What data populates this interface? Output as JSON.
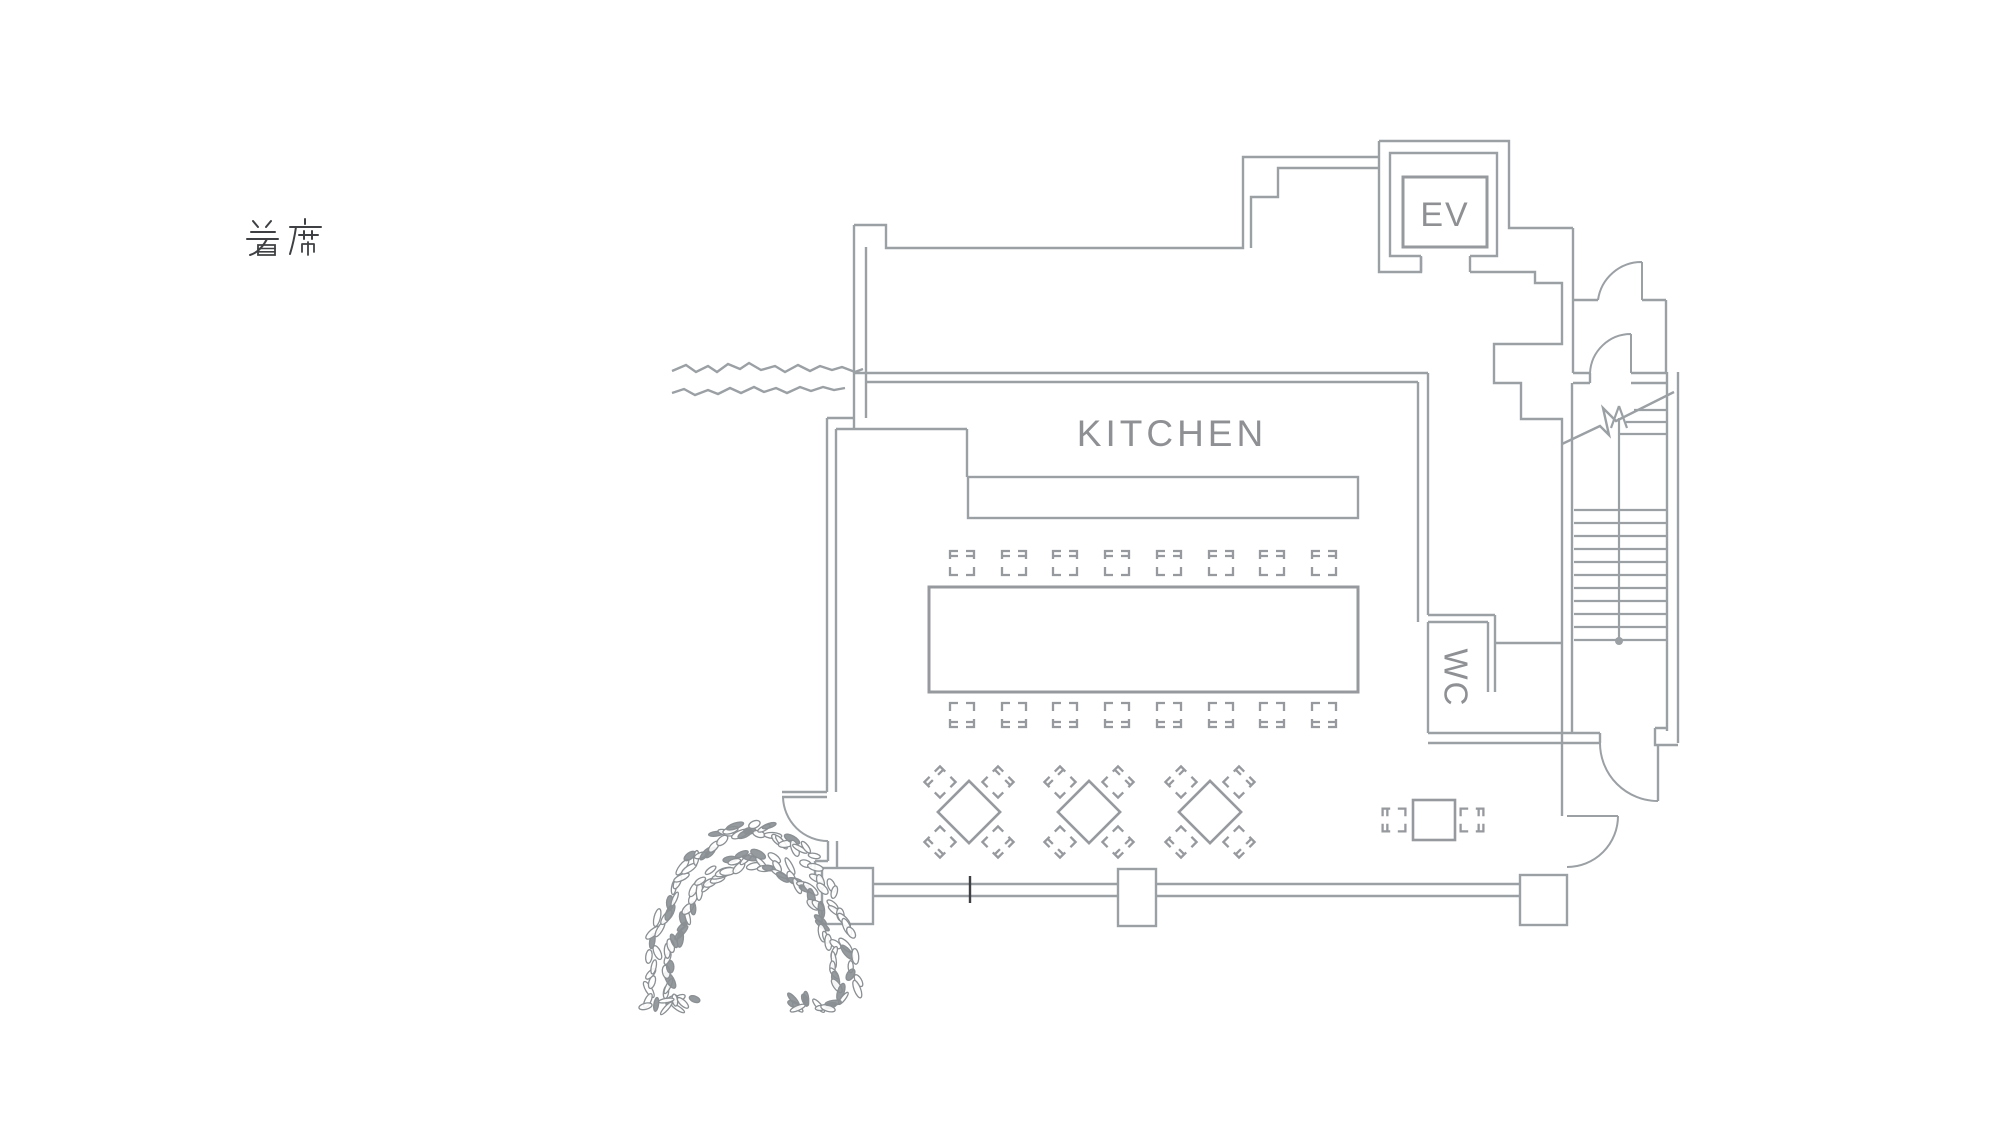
{
  "plan": {
    "seating_label": "着席",
    "labels": {
      "kitchen": "KITCHEN",
      "elevator": "EV",
      "toilet": "WC"
    },
    "colors": {
      "wall": "#9ba0a5",
      "furniture": "#96999d",
      "label_text": "#8e9094",
      "seating_text": "#3e4043",
      "tick": "#3f4043",
      "leaf": "#8a8f93"
    },
    "furniture": {
      "banquet_table": {
        "x": 929,
        "y": 587,
        "width": 429,
        "height": 105
      },
      "banquet_chair_xs": [
        962,
        1014,
        1065,
        1117,
        1169,
        1221,
        1272,
        1324
      ],
      "banquet_chair_rows": [
        {
          "y": 563,
          "rot": 0
        },
        {
          "y": 715,
          "rot": 180
        }
      ],
      "square_tables": {
        "centers": [
          [
            969,
            812
          ],
          [
            1089,
            812
          ],
          [
            1210,
            812
          ]
        ],
        "side": 44,
        "rotation": 45,
        "chair_offsets": [
          [
            -29,
            -30,
            315
          ],
          [
            29,
            -30,
            45
          ],
          [
            29,
            30,
            135
          ],
          [
            -29,
            30,
            225
          ]
        ]
      },
      "side_table": {
        "x": 1413,
        "y": 800,
        "width": 42,
        "height": 40
      },
      "side_chairs": [
        [
          1394,
          820,
          270
        ],
        [
          1472,
          820,
          90
        ]
      ],
      "kitchen_counter": {
        "x": 968,
        "y": 477,
        "width": 390,
        "height": 41
      }
    },
    "stairs": {
      "x1": 1574,
      "x2": 1666,
      "treads_y_start": 510,
      "tread_step": 13,
      "tread_count": 11,
      "upper_treads": [
        [
          1634,
          410
        ],
        [
          1626,
          422
        ],
        [
          1620,
          434
        ]
      ],
      "stringer_x": 1619,
      "stringer_top": 418,
      "stringer_bottom": 641,
      "dot_r": 4
    },
    "arch": {
      "cx": 752,
      "base_y": 1006,
      "half_span": 95,
      "rise": 161,
      "leaf_count": 66,
      "tufts": [
        [
          668,
          1002
        ],
        [
          820,
          1002
        ]
      ]
    },
    "pillars": [
      {
        "x": 1118,
        "y": 869,
        "width": 38,
        "height": 57
      },
      {
        "x": 1520,
        "y": 875,
        "width": 47,
        "height": 50
      },
      {
        "x": 822,
        "y": 868,
        "width": 51,
        "height": 56
      }
    ],
    "wall_tick": {
      "x": 970,
      "y1": 876,
      "y2": 903
    }
  }
}
